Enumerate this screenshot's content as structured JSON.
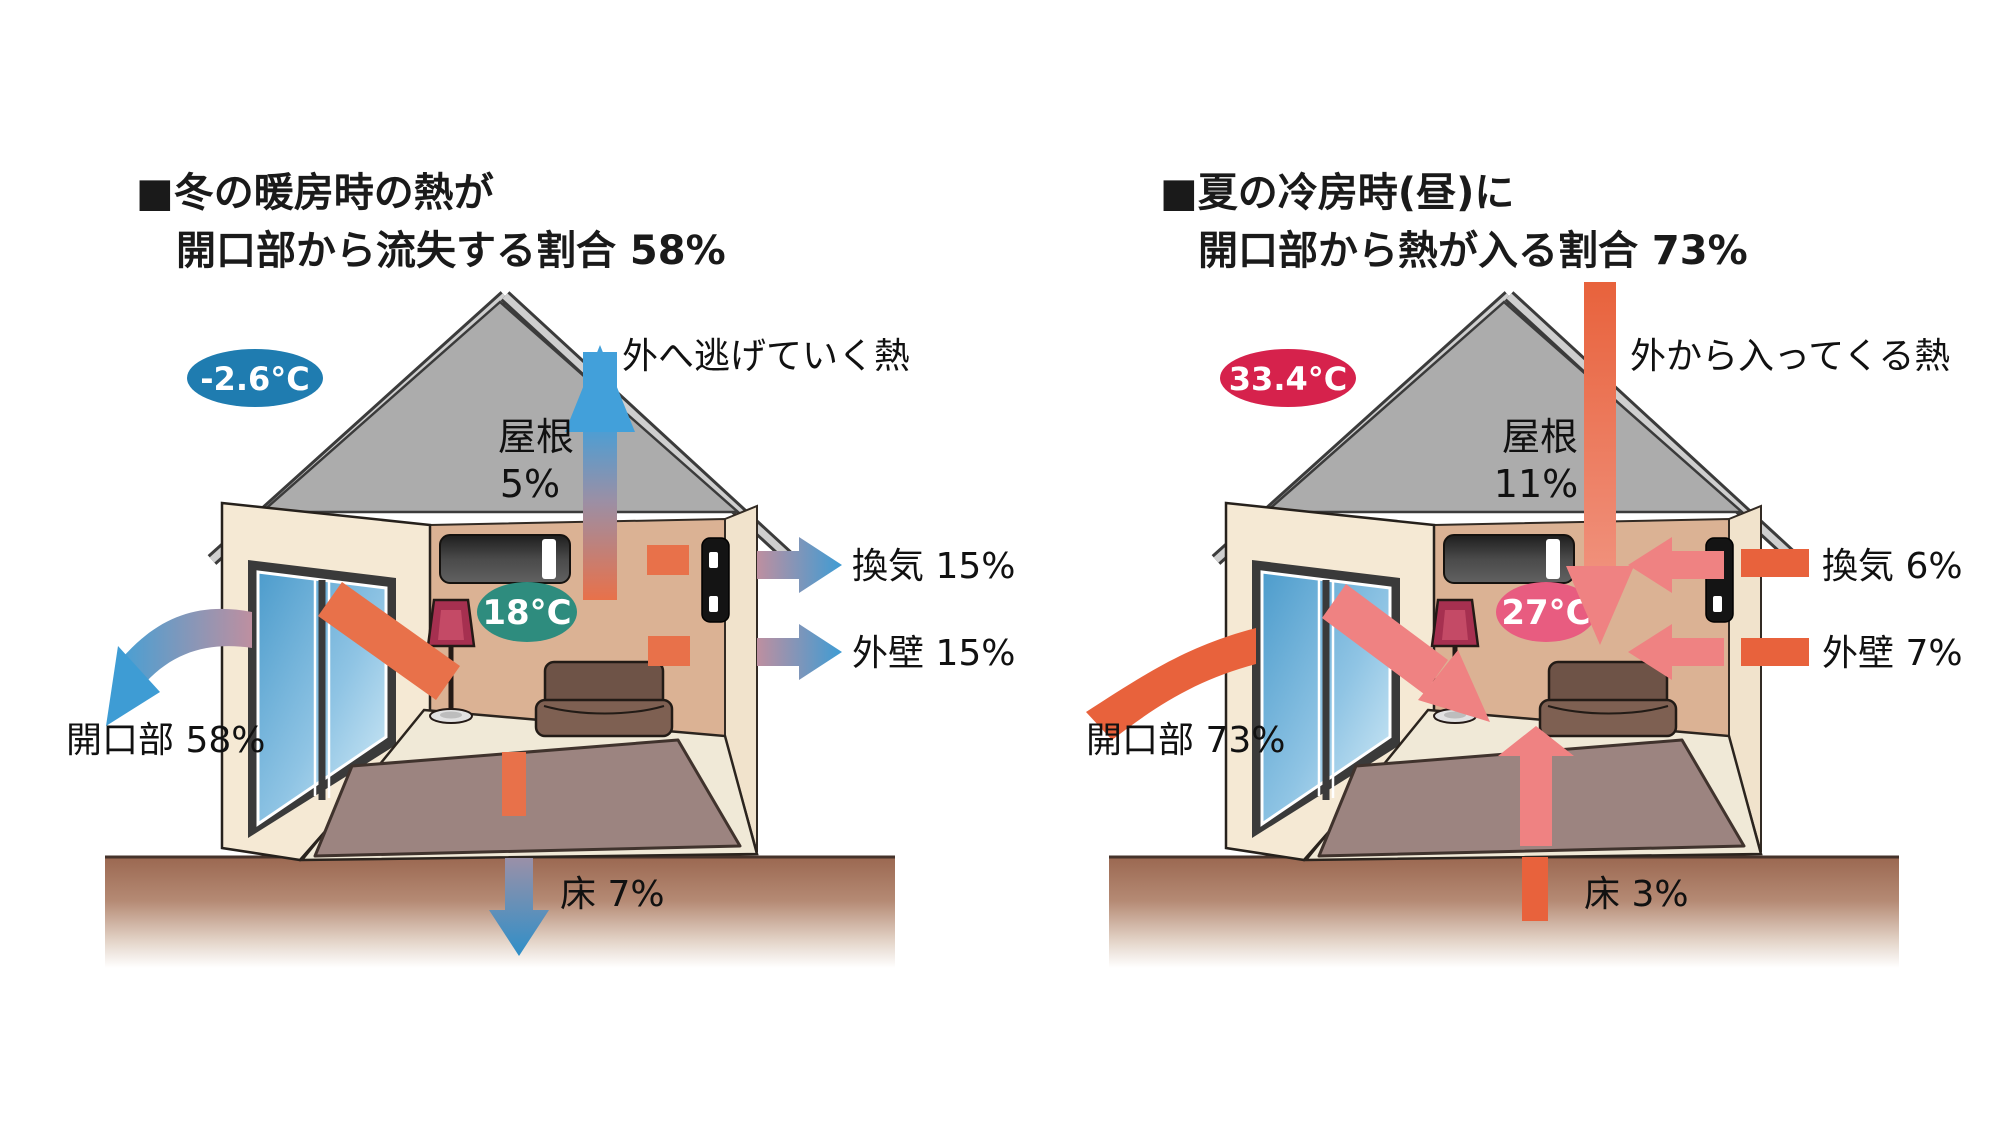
{
  "panels": [
    {
      "id": "winter-heat-loss",
      "title_line1": "■冬の暖房時の熱が",
      "title_line2": "開口部から流失する割合 58%",
      "outdoor_temp": "-2.6°C",
      "indoor_temp": "18°C",
      "flow_note": "外へ逃げていく熱",
      "roof_label": "屋根",
      "roof_value": "5%",
      "vent_label": "換気 15%",
      "wall_label": "外壁 15%",
      "opening_label": "開口部 58%",
      "floor_label": "床 7%"
    },
    {
      "id": "summer-heat-gain",
      "title_line1": "■夏の冷房時(昼)に",
      "title_line2": "開口部から熱が入る割合 73%",
      "outdoor_temp": "33.4°C",
      "indoor_temp": "27°C",
      "flow_note": "外から入ってくる熱",
      "roof_label": "屋根",
      "roof_value": "11%",
      "vent_label": "換気 6%",
      "wall_label": "外壁 7%",
      "opening_label": "開口部 73%",
      "floor_label": "床 3%"
    }
  ],
  "colors": {
    "heat_out_blue": "#3E9CD4",
    "heat_in_orange": "#E8623C",
    "indoor_heat_orange": "#E8714A",
    "heat_in_salmon": "#EF8282",
    "winter_outdoor_badge": "#1F7CB0",
    "winter_indoor_badge": "#2E8C7E",
    "summer_outdoor_badge": "#D6224C",
    "summer_indoor_badge": "#E85C80",
    "roof_gray": "#ACACAC",
    "wall_cream": "#F5E9D4",
    "back_wall_tan": "#DBB294",
    "carpet_mauve": "#9C8480",
    "ground_brown": "#9A6750"
  }
}
